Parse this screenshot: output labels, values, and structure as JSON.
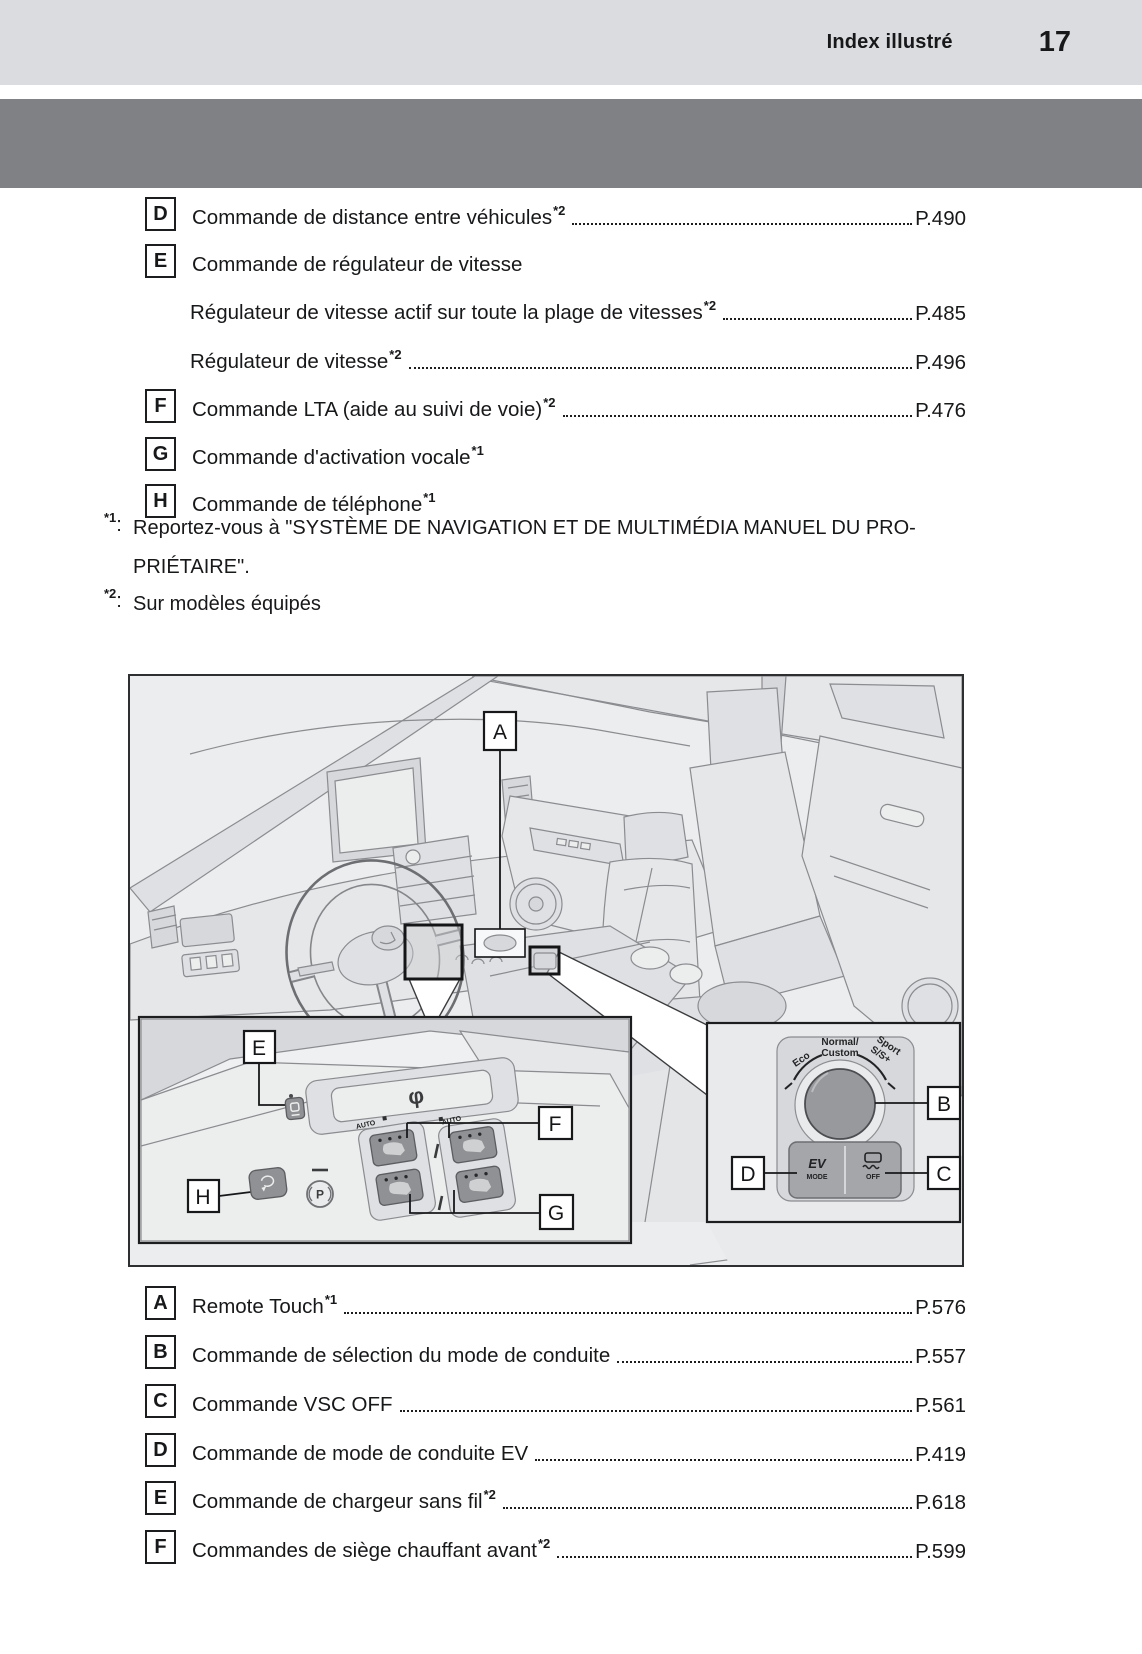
{
  "colors": {
    "band_light": "#dbdcdf",
    "band_dark": "#7f8184",
    "figure_background": "#ecedee",
    "text": "#17181a"
  },
  "header": {
    "label": "Index illustré",
    "page_number": "17"
  },
  "top_list": {
    "items": [
      {
        "letter": "D",
        "label": "Commande de distance entre véhicules",
        "sup": "*2",
        "page": "P.490"
      },
      {
        "letter": "E",
        "label": "Commande de régulateur de vitesse",
        "sup": "",
        "page": ""
      },
      {
        "letter": "",
        "label": "Régulateur de vitesse actif sur toute la plage de vitesses",
        "sup": "*2",
        "page": "P.485"
      },
      {
        "letter": "",
        "label": "Régulateur de vitesse",
        "sup": "*2",
        "page": "P.496"
      },
      {
        "letter": "F",
        "label": "Commande LTA (aide au suivi de voie)",
        "sup": "*2",
        "page": "P.476"
      },
      {
        "letter": "G",
        "label": "Commande d'activation vocale",
        "sup": "*1",
        "page": ""
      },
      {
        "letter": "H",
        "label": "Commande de téléphone",
        "sup": "*1",
        "page": ""
      }
    ]
  },
  "footnotes": {
    "fn1_marker": "*1",
    "fn1_colon": ":",
    "fn1_line1": "Reportez-vous à \"SYSTÈME DE NAVIGATION ET DE MULTIMÉDIA MANUEL DU PRO-",
    "fn1_line2": "PRIÉTAIRE\".",
    "fn2_marker": "*2",
    "fn2_colon": ":",
    "fn2_text": "Sur modèles équipés"
  },
  "illustration": {
    "callouts": {
      "a": "A",
      "b": "B",
      "c": "C",
      "d": "D",
      "e": "E",
      "f": "F",
      "g": "G",
      "h": "H"
    },
    "mode_selector": {
      "eco": "Eco",
      "normal_line1": "Normal/",
      "normal_line2": "Custom",
      "sport_line1": "Sport",
      "sport_line2": "S/S+",
      "ev": "EV",
      "ev_sub": "MODE",
      "vsc_off": "OFF"
    },
    "console": {
      "auto_left": "AUTO",
      "auto_right": "AUTO",
      "parking": "P",
      "qi": "φ"
    }
  },
  "bottom_list": {
    "items": [
      {
        "letter": "A",
        "label": "Remote Touch",
        "sup": "*1",
        "page": "P.576"
      },
      {
        "letter": "B",
        "label": "Commande de sélection du mode de conduite",
        "sup": "",
        "page": "P.557"
      },
      {
        "letter": "C",
        "label": "Commande VSC OFF",
        "sup": "",
        "page": "P.561"
      },
      {
        "letter": "D",
        "label": "Commande de mode de conduite EV",
        "sup": "",
        "page": "P.419"
      },
      {
        "letter": "E",
        "label": "Commande de chargeur sans fil",
        "sup": "*2",
        "page": "P.618"
      },
      {
        "letter": "F",
        "label": "Commandes de siège chauffant avant",
        "sup": "*2",
        "page": "P.599"
      }
    ]
  }
}
